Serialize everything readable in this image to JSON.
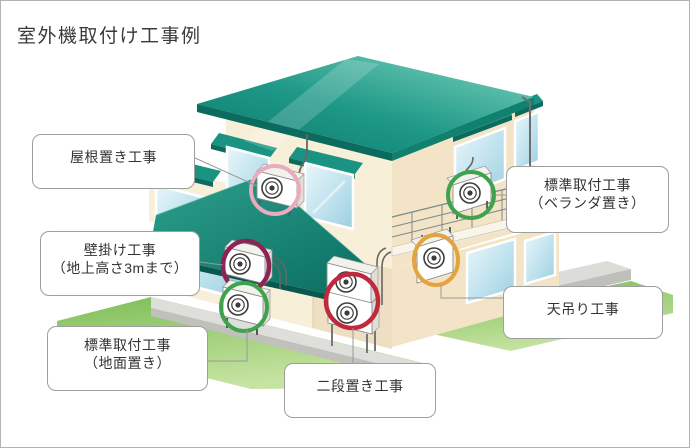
{
  "title": "室外機取付け工事例",
  "callouts": {
    "roof": {
      "label": "屋根置き工事",
      "circle_color": "#E9ABBE"
    },
    "wall": {
      "label": "壁掛け工事",
      "label2": "（地上高さ3mまで）",
      "circle_color": "#8D2455"
    },
    "ground": {
      "label": "標準取付工事",
      "label2": "（地面置き）",
      "circle_color": "#3FA34D"
    },
    "two_tier": {
      "label": "二段置き工事",
      "circle_color": "#C0283C"
    },
    "veranda": {
      "label": "標準取付工事",
      "label2": "（ベランダ置き）",
      "circle_color": "#3FA34D"
    },
    "ceiling": {
      "label": "天吊り工事",
      "circle_color": "#E5A33E"
    }
  },
  "colors": {
    "roof_teal": "#1B9383",
    "wall_cream": "#F8EFD9",
    "window_blue": "#BFE2EE",
    "grass_green": "#8CC764",
    "concrete_gray": "#DEDEDA",
    "connector_gray": "#999999",
    "frame_border": "#B3B3B3",
    "text_dark": "#333333"
  },
  "diagram_type": "isometric house with six outdoor AC unit installation examples"
}
